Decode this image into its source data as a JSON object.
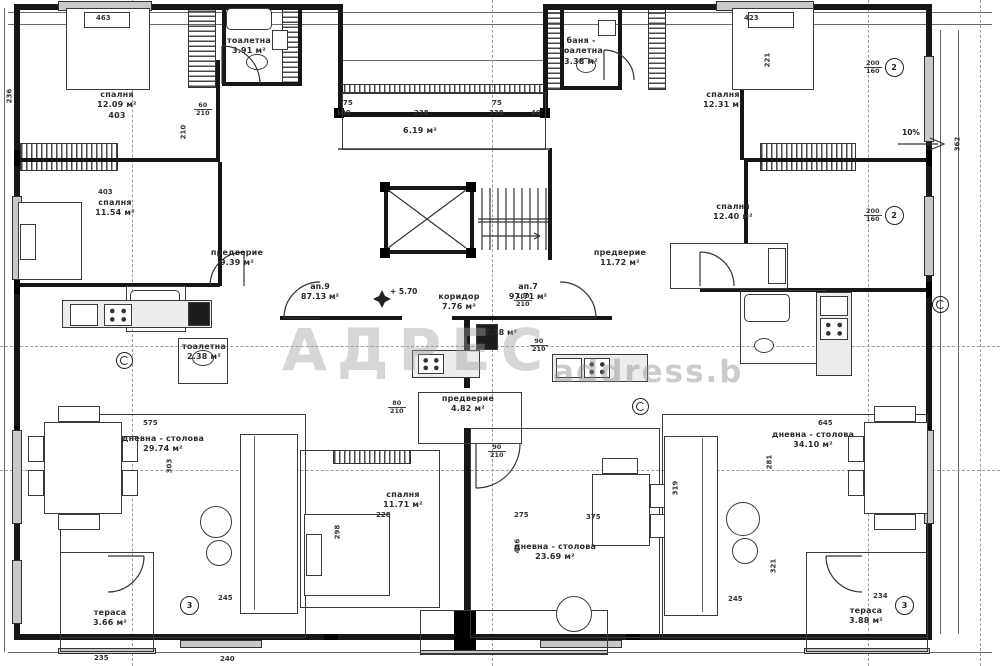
{
  "watermark": {
    "brand": "АДРЕС",
    "site": "address.b"
  },
  "annotations": {
    "level": "+ 5.70",
    "slope": "10%"
  },
  "apartments": [
    {
      "name": "ап.9",
      "area": "87.13 м²"
    },
    {
      "name": "ап.7",
      "area": "97.71 м²"
    },
    {
      "name": "",
      "area": "87.18 м²"
    }
  ],
  "rooms": [
    {
      "name": "спалня",
      "area": "12.09 м²",
      "dim": "403"
    },
    {
      "name": "тоалетна",
      "area": "3.91 м²",
      "dim": ""
    },
    {
      "name": "спалня",
      "area": "12.31 м²",
      "dim": ""
    },
    {
      "name": "баня - тоалетна",
      "area": "3.38 м²",
      "dim": ""
    },
    {
      "name": "",
      "area": "6.19 м²",
      "dim": ""
    },
    {
      "name": "спалня",
      "area": "11.54 м²",
      "dim": ""
    },
    {
      "name": "предверие",
      "area": "9.39 м²",
      "dim": ""
    },
    {
      "name": "спалня",
      "area": "12.40 м²",
      "dim": ""
    },
    {
      "name": "предверие",
      "area": "11.72 м²",
      "dim": ""
    },
    {
      "name": "коридор",
      "area": "7.76 м²",
      "dim": ""
    },
    {
      "name": "тоалетна",
      "area": "2.38 м²",
      "dim": ""
    },
    {
      "name": "предверие",
      "area": "4.82 м²",
      "dim": ""
    },
    {
      "name": "спалня",
      "area": "11.71 м²",
      "dim": ""
    },
    {
      "name": "дневна - столова",
      "area": "29.74 м²",
      "dim": ""
    },
    {
      "name": "дневна - столова",
      "area": "23.69 м²",
      "dim": ""
    },
    {
      "name": "дневна - столова",
      "area": "34.10 м²",
      "dim": ""
    },
    {
      "name": "тераса",
      "area": "3.66 м²",
      "dim": ""
    },
    {
      "name": "тераса",
      "area": "3.88 м²",
      "dim": ""
    }
  ],
  "dims": [
    "463",
    "423",
    "403",
    "75",
    "100",
    "238",
    "338",
    "40",
    "75",
    "210",
    "236",
    "362",
    "575",
    "645",
    "303",
    "281",
    "319",
    "321",
    "228",
    "275",
    "416",
    "245",
    "245",
    "234",
    "235",
    "240",
    "221",
    "298",
    "375"
  ],
  "door_sizes": [
    {
      "top": "100",
      "bottom": "210"
    },
    {
      "top": "90",
      "bottom": "210"
    },
    {
      "top": "80",
      "bottom": "210"
    },
    {
      "top": "60",
      "bottom": "210"
    },
    {
      "top": "90",
      "bottom": "210"
    }
  ],
  "window_marks": [
    {
      "top": "200",
      "bottom": "160",
      "ref": "2"
    },
    {
      "top": "200",
      "bottom": "160",
      "ref": "2"
    },
    {
      "top": "",
      "bottom": "",
      "ref": "3"
    },
    {
      "top": "",
      "bottom": "",
      "ref": "3"
    }
  ]
}
